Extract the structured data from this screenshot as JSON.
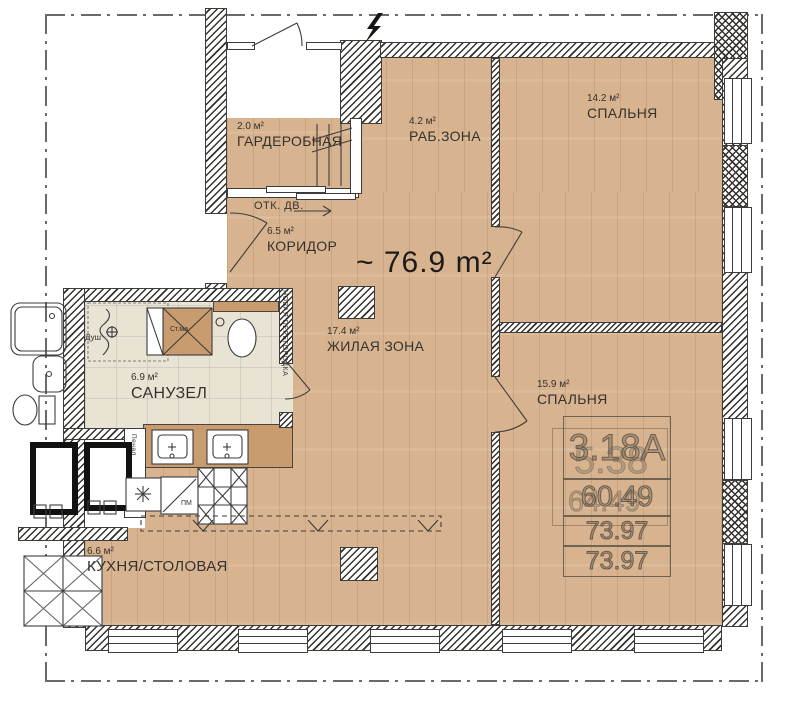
{
  "plan": {
    "total_area": "~ 76.9 m²",
    "rooms": [
      {
        "area": "2.0 м²",
        "name": "ГАРДЕРОБНАЯ"
      },
      {
        "area": "6.5 м²",
        "name": "КОРИДОР"
      },
      {
        "area": "4.2 м²",
        "name": "РАБ.ЗОНА"
      },
      {
        "area": "14.2 м²",
        "name": "СПАЛЬНЯ"
      },
      {
        "area": "17.4 м²",
        "name": "ЖИЛАЯ ЗОНА"
      },
      {
        "area": "6.9 м²",
        "name": "САНУЗЕЛ"
      },
      {
        "area": "15.9 м²",
        "name": "СПАЛЬНЯ"
      },
      {
        "area": "6.6 м²",
        "name": "КУХНЯ/СТОЛОВАЯ"
      }
    ],
    "annotations": {
      "sliding_door": "ОТК. ДВ.",
      "new_partition": "НОВАЯ ПЕРЕГОРОДКА",
      "shower": "Душ",
      "washing_machine": "Ст.ма",
      "tall_cabinet": "Пенал",
      "dishwasher": "ПМ"
    },
    "stamp": {
      "row1": "3.18А",
      "row1_ghost": "5.38",
      "row2": "60.49",
      "row2_ghost": "64.49",
      "row3": "73.97",
      "row4": "73.97"
    },
    "colors": {
      "floor_wood": "#d8b38f",
      "tile": "#e9e3d4",
      "counter": "#c99c6f",
      "line": "#3c3c3c"
    }
  }
}
